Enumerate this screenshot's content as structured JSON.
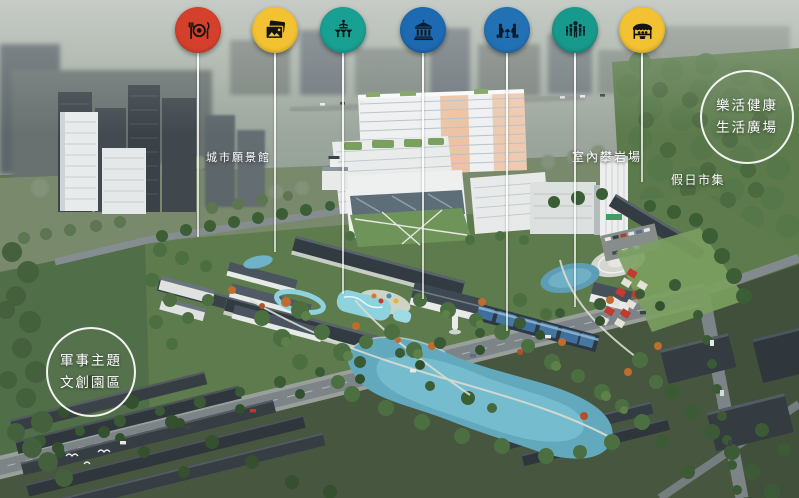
{
  "scene": {
    "type": "aerial-masterplan-render",
    "area_labels": {
      "city_vision_hall": "城市願景館",
      "indoor_climbing": "室內攀岩場",
      "holiday_market": "假日市集"
    },
    "zone_badges": {
      "lohas": {
        "line1": "樂活健康",
        "line2": "生活廣場"
      },
      "military": {
        "line1": "軍事主題",
        "line2": "文創園區"
      }
    }
  },
  "markers": [
    {
      "icon": "dining-icon",
      "color": "#d5402c",
      "x": 198,
      "line_end": 238
    },
    {
      "icon": "photos-icon",
      "color": "#f2c233",
      "x": 275,
      "line_end": 253
    },
    {
      "icon": "performance-icon",
      "color": "#18a092",
      "x": 343,
      "line_end": 295
    },
    {
      "icon": "museum-icon",
      "color": "#1d69b2",
      "x": 423,
      "line_end": 300
    },
    {
      "icon": "seniors-icon",
      "color": "#2271b5",
      "x": 507,
      "line_end": 332
    },
    {
      "icon": "family-icon",
      "color": "#17998b",
      "x": 575,
      "line_end": 308
    },
    {
      "icon": "market-icon",
      "color": "#f2c233",
      "x": 642,
      "line_end": 183
    }
  ]
}
